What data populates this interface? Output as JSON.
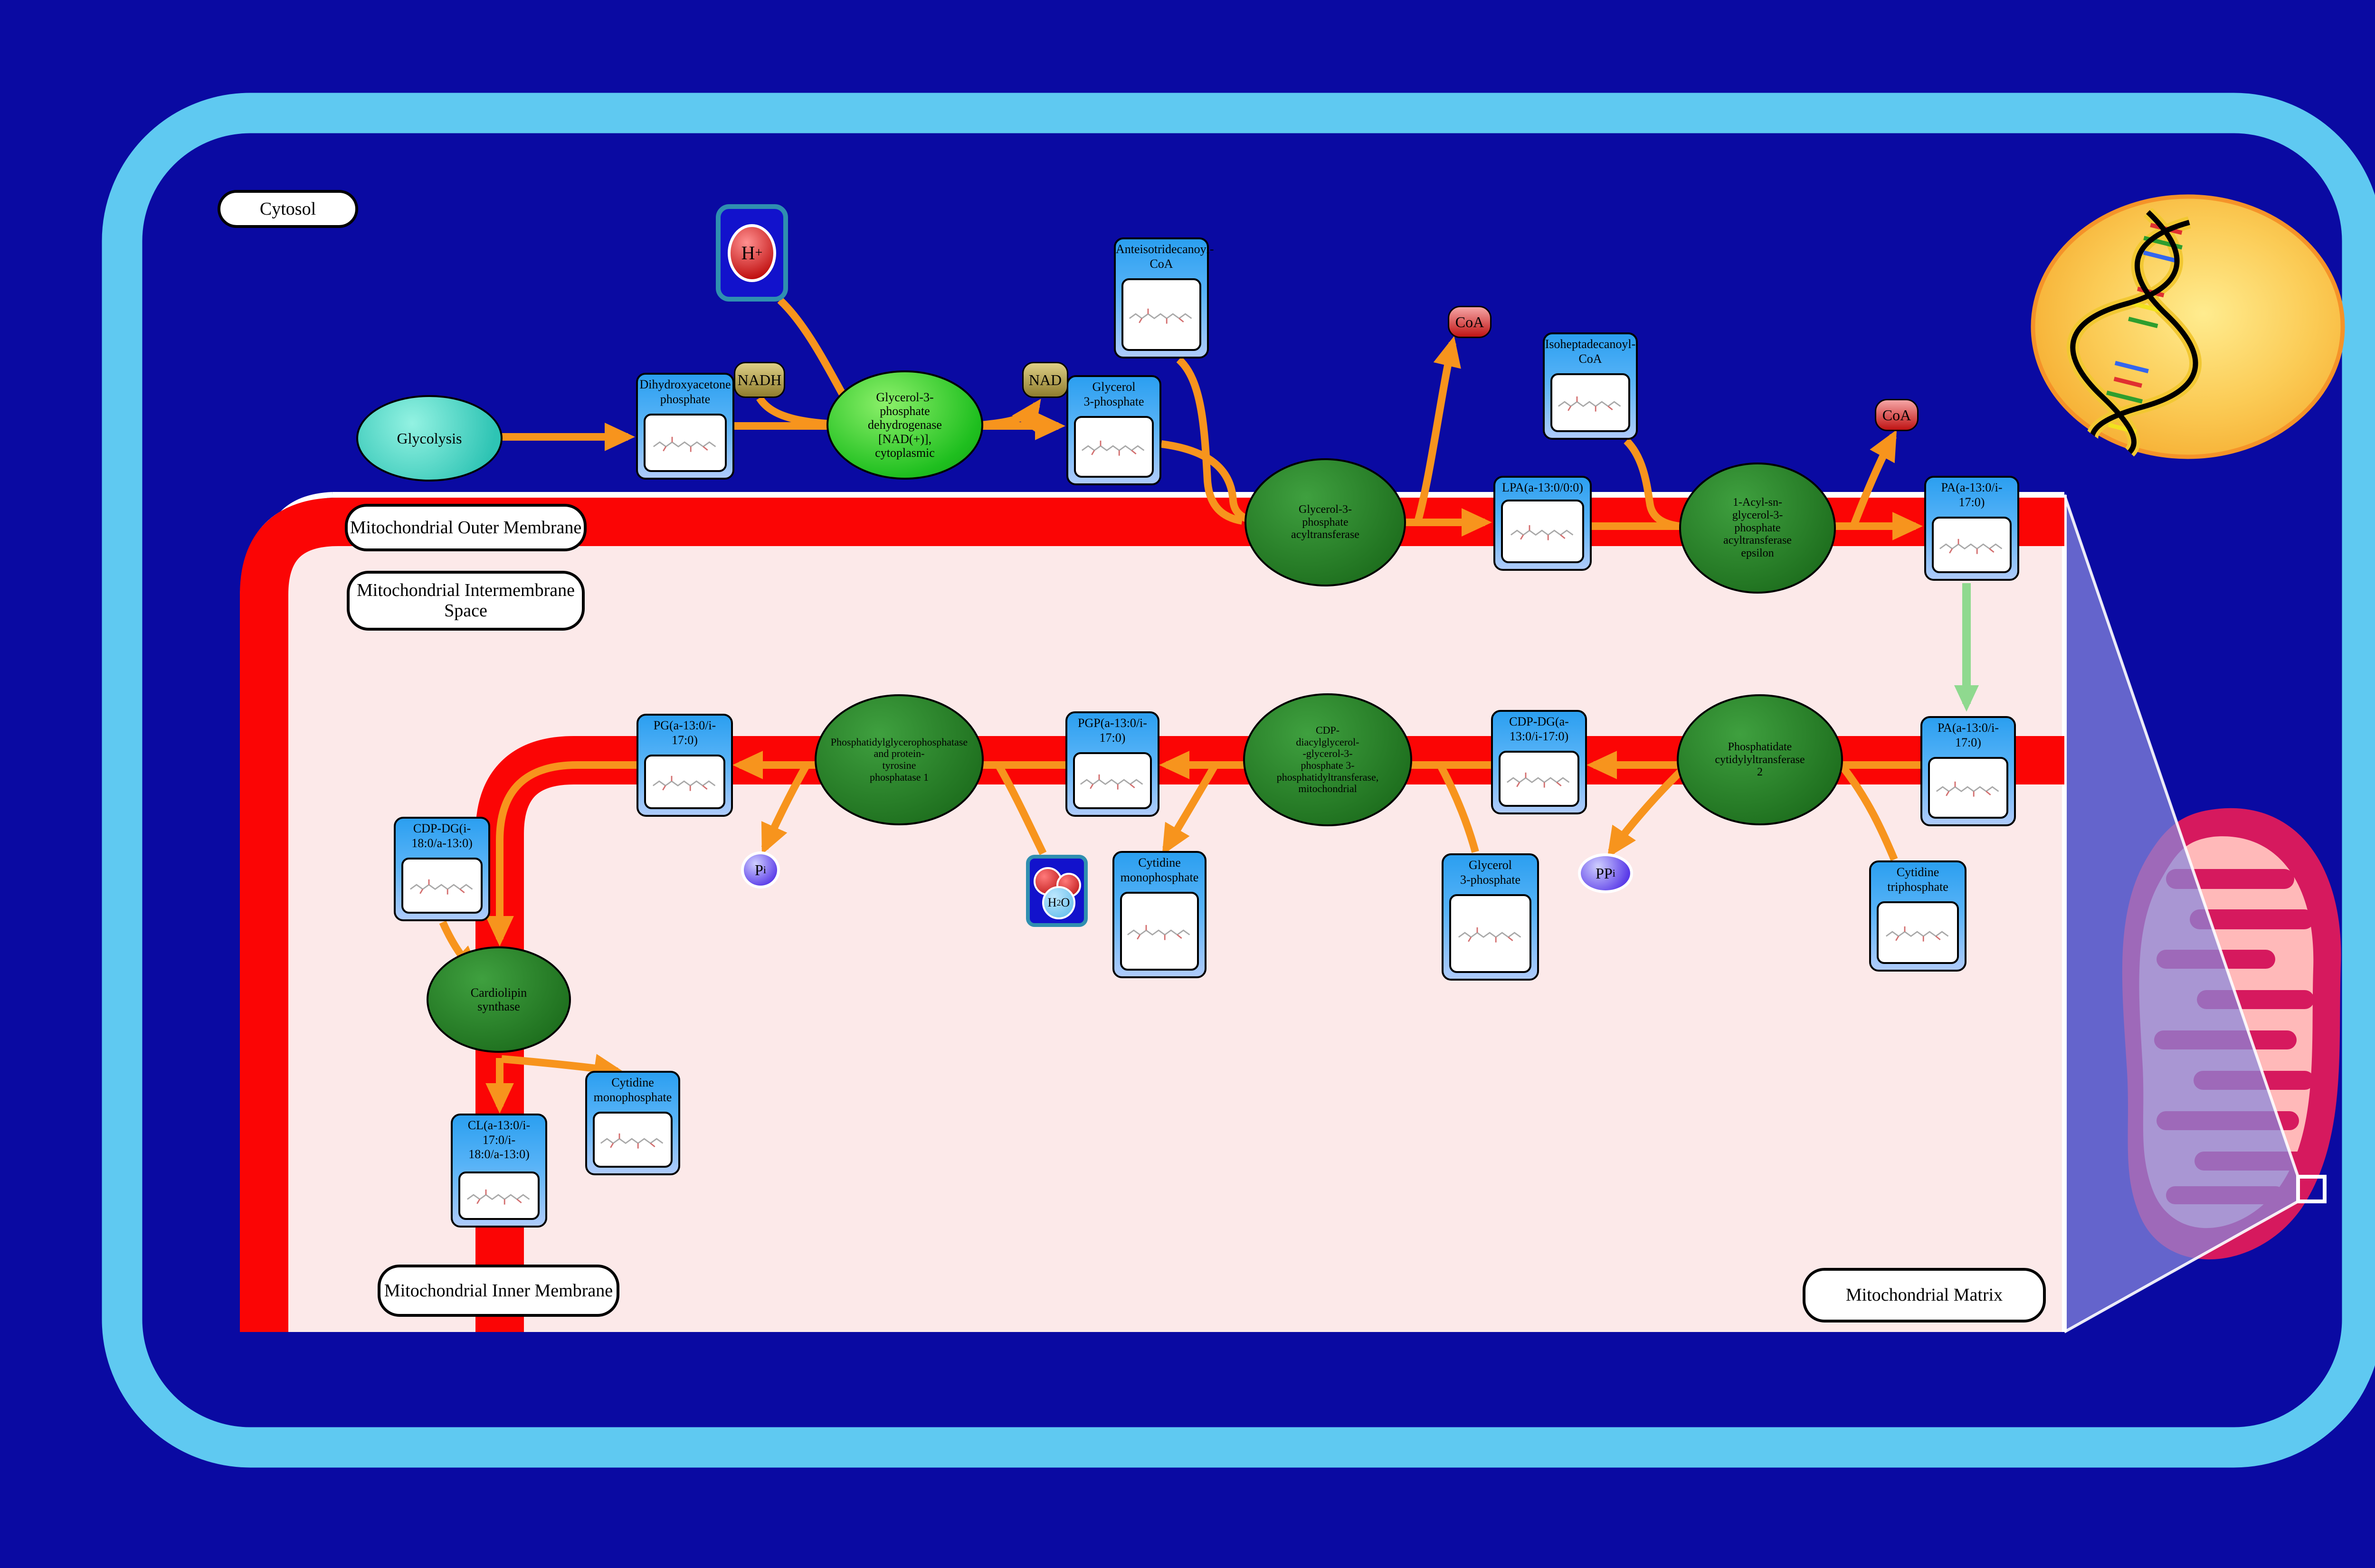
{
  "compartments": [
    {
      "id": "cytosol",
      "label": "Cytosol"
    },
    {
      "id": "outer-membrane",
      "label": "Mitochondrial Outer Membrane"
    },
    {
      "id": "intermembrane-space",
      "label": "Mitochondrial Intermembrane\nSpace"
    },
    {
      "id": "inner-membrane",
      "label": "Mitochondrial Inner Membrane"
    },
    {
      "id": "matrix",
      "label": "Mitochondrial Matrix"
    }
  ],
  "process_nodes": [
    {
      "id": "glycolysis",
      "label": "Glycolysis"
    }
  ],
  "metabolites": [
    {
      "id": "dhap",
      "label": "Dihydroxyacetone\nphosphate"
    },
    {
      "id": "g3p-top",
      "label": "Glycerol\n3-phosphate"
    },
    {
      "id": "anteiso-coa",
      "label": "Anteisotridecanoyl-\nCoA"
    },
    {
      "id": "isohep-coa",
      "label": "Isoheptadecanoyl-\nCoA"
    },
    {
      "id": "lpa",
      "label": "LPA(a-13:0/0:0)"
    },
    {
      "id": "pa-1",
      "label": "PA(a-13:0/i-\n17:0)"
    },
    {
      "id": "pa-2",
      "label": "PA(a-13:0/i-\n17:0)"
    },
    {
      "id": "cdp-dg-1",
      "label": "CDP-DG(a-\n13:0/i-17:0)"
    },
    {
      "id": "pgp",
      "label": "PGP(a-13:0/i-\n17:0)"
    },
    {
      "id": "pg",
      "label": "PG(a-13:0/i-\n17:0)"
    },
    {
      "id": "cmp-mid",
      "label": "Cytidine\nmonophosphate"
    },
    {
      "id": "g3p-matrix",
      "label": "Glycerol\n3-phosphate"
    },
    {
      "id": "ctp",
      "label": "Cytidine\ntriphosphate"
    },
    {
      "id": "cdp-dg-2",
      "label": "CDP-DG(i-\n18:0/a-13:0)"
    },
    {
      "id": "cl",
      "label": "CL(a-13:0/i-\n17:0/i-\n18:0/a-13:0)"
    },
    {
      "id": "cmp-bottom",
      "label": "Cytidine\nmonophosphate"
    }
  ],
  "enzymes": [
    {
      "id": "gpd",
      "label": "Glycerol-3-\nphosphate\ndehydrogenase\n[NAD(+)],\ncytoplasmic",
      "style": "bright"
    },
    {
      "id": "gpat",
      "label": "Glycerol-3-\nphosphate\nacyltransferase",
      "style": "dark"
    },
    {
      "id": "agpat",
      "label": "1-Acyl-sn-\nglycerol-3-\nphosphate\nacyltransferase\nepsilon",
      "style": "dark"
    },
    {
      "id": "pct2",
      "label": "Phosphatidate\ncytidylyltransferase\n2",
      "style": "dark"
    },
    {
      "id": "cdgppt",
      "label": "CDP-\ndiacylglycerol-\n-glycerol-3-\nphosphate 3-\nphosphatidyltransferase,\nmitochondrial",
      "style": "dark"
    },
    {
      "id": "pgpp",
      "label": "Phosphatidylglycerophosphatase\nand protein-\ntyrosine\nphosphatase 1",
      "style": "dark"
    },
    {
      "id": "cls",
      "label": "Cardiolipin\nsynthase",
      "style": "dark"
    }
  ],
  "small_molecules": [
    {
      "id": "h-plus",
      "text": "H",
      "sup": "+",
      "kind": "proton-box"
    },
    {
      "id": "nadh",
      "text": "NADH",
      "kind": "cofactor-pill"
    },
    {
      "id": "nad",
      "text": "NAD",
      "kind": "cofactor-pill"
    },
    {
      "id": "coa-1",
      "text": "CoA",
      "kind": "coa-pill"
    },
    {
      "id": "coa-2",
      "text": "CoA",
      "kind": "coa-pill"
    },
    {
      "id": "pi",
      "text": "P",
      "sub": "i",
      "kind": "phosphate-blob"
    },
    {
      "id": "ppi",
      "text": "PP",
      "sub": "i",
      "kind": "phosphate-blob"
    },
    {
      "id": "h2o",
      "text": "H",
      "sub": "2",
      "text2": "O",
      "kind": "water-box"
    }
  ],
  "colors": {
    "background": "#0A0AA2",
    "cell_border": "#5FC9F1",
    "membrane_red": "#FB0505",
    "mito_space_pink": "#FCE9E9",
    "node_blue_top": "#2B9FF0",
    "node_blue_bottom": "#AECBFB",
    "enzyme_dark_green": "#1E6F1E",
    "enzyme_bright_green": "#1FBF1F",
    "arrow_orange": "#F7941D",
    "transport_arrow_green": "#8FD98F",
    "cofactor_khaki": "#B8A858",
    "coa_red": "#C21515",
    "phosphate_purple": "#5A3BE8",
    "nucleus_gold": "#F8B83C",
    "mitochondrion_crimson": "#D6195E",
    "mitochondrion_pink": "#FFB9B9",
    "zoom_beam_purple": "#8888DD"
  }
}
